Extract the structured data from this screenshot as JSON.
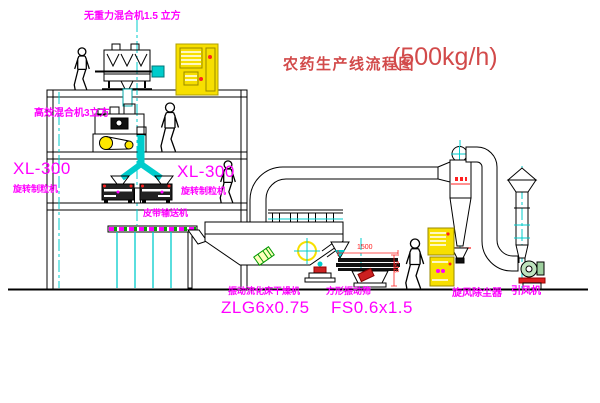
{
  "diagram": {
    "title": "农药生产线流程图",
    "capacity": "(500kg/h)"
  },
  "labels": {
    "top_mixer": "无重力混合机1.5 立方",
    "mid_mixer": "高效混合机3立方",
    "granulator_left_model": "XL-300",
    "granulator_left_name": "旋转制粒机",
    "granulator_mid_model": "XL-300",
    "granulator_mid_name": "旋转制粒机",
    "belt_conveyor": "皮带输送机",
    "dryer_name": "振动流化床干燥机",
    "dryer_model": "ZLG6x0.75",
    "screen_name": "方形振动筛",
    "screen_model": "FS0.6x1.5",
    "cyclone": "旋风除尘器",
    "fan": "引风机"
  },
  "dimensions": {
    "screen_length": "1500",
    "screen_height": "548"
  },
  "colors": {
    "outline": "#000000",
    "centerline_cyan": "#00cccc",
    "label_magenta": "#ff00ff",
    "title_red": "#d24a4a",
    "dimension_red": "#ff2020",
    "cabinet_yellow": "#f7df00"
  }
}
